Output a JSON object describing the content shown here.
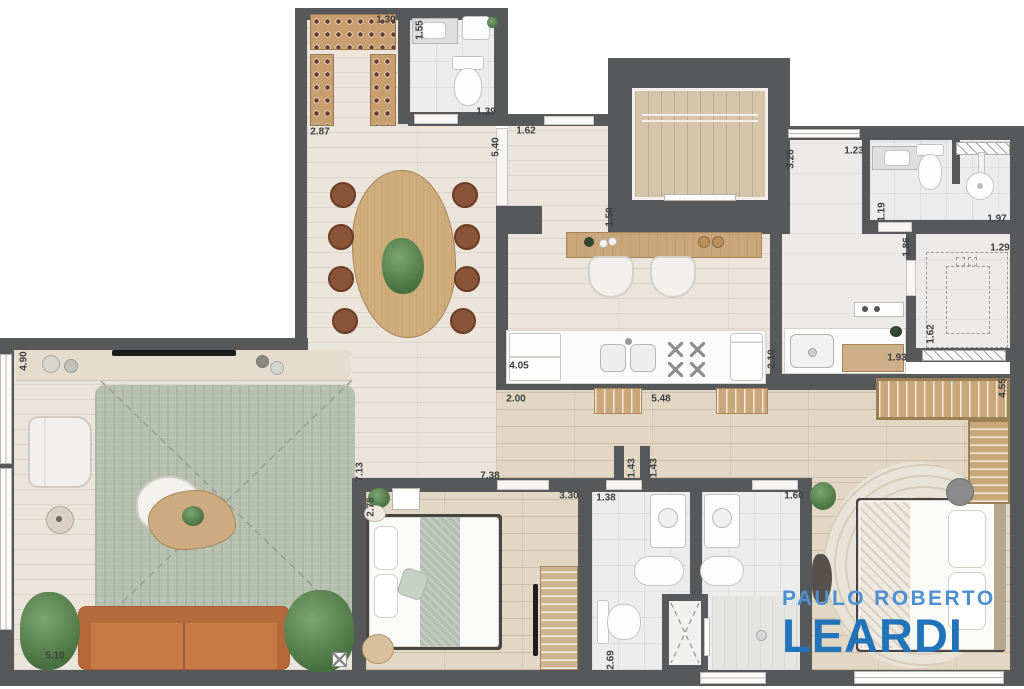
{
  "brand": {
    "line1": "PAULO ROBERTO",
    "line2": "LEARDI"
  },
  "colors": {
    "wall": "#57585a",
    "floor_tile": "#ebe4db",
    "floor_wood": "#e2d6c4",
    "floor_bath": "#ececec",
    "rug_living": "#b7bfae",
    "rug_master": "#e9e2d6",
    "sofa": "#c2713e",
    "wood_furniture": "#caa77a",
    "dining_chair": "#8a5438",
    "plant": "#47703f",
    "brand_light_blue": "#4c90d3",
    "brand_bold_blue": "#2173ba"
  },
  "icons": {
    "shower-head": "circle",
    "stove-burner": "x-cross",
    "shower-glass": "dashed-x",
    "floor-drain": "boxed-x"
  },
  "dimension_labels": [
    {
      "text": "1.30",
      "x": 386,
      "y": 20,
      "vertical": false
    },
    {
      "text": "1.55",
      "x": 420,
      "y": 30,
      "vertical": true
    },
    {
      "text": "2.87",
      "x": 320,
      "y": 132,
      "vertical": false
    },
    {
      "text": "1.39",
      "x": 486,
      "y": 112,
      "vertical": false
    },
    {
      "text": "5.40",
      "x": 496,
      "y": 147,
      "vertical": true
    },
    {
      "text": "1.62",
      "x": 526,
      "y": 131,
      "vertical": false
    },
    {
      "text": "1.50",
      "x": 610,
      "y": 217,
      "vertical": true
    },
    {
      "text": "3.26",
      "x": 791,
      "y": 159,
      "vertical": true
    },
    {
      "text": "1.23",
      "x": 854,
      "y": 151,
      "vertical": false
    },
    {
      "text": "1.19",
      "x": 882,
      "y": 212,
      "vertical": true
    },
    {
      "text": "1.97",
      "x": 997,
      "y": 219,
      "vertical": false
    },
    {
      "text": "1.86",
      "x": 907,
      "y": 247,
      "vertical": true
    },
    {
      "text": "1.29",
      "x": 1000,
      "y": 248,
      "vertical": false
    },
    {
      "text": "1.62",
      "x": 931,
      "y": 334,
      "vertical": true
    },
    {
      "text": "1.93",
      "x": 897,
      "y": 358,
      "vertical": false
    },
    {
      "text": "4.05",
      "x": 519,
      "y": 366,
      "vertical": false
    },
    {
      "text": "2.10",
      "x": 772,
      "y": 359,
      "vertical": true
    },
    {
      "text": "4.90",
      "x": 24,
      "y": 361,
      "vertical": true
    },
    {
      "text": "2.00",
      "x": 516,
      "y": 399,
      "vertical": false
    },
    {
      "text": "5.48",
      "x": 661,
      "y": 399,
      "vertical": false
    },
    {
      "text": "4.55",
      "x": 1003,
      "y": 388,
      "vertical": true
    },
    {
      "text": "7.13",
      "x": 360,
      "y": 472,
      "vertical": true
    },
    {
      "text": "7.38",
      "x": 490,
      "y": 476,
      "vertical": false
    },
    {
      "text": "2.75",
      "x": 371,
      "y": 507,
      "vertical": true
    },
    {
      "text": "3.30",
      "x": 569,
      "y": 496,
      "vertical": false
    },
    {
      "text": "1.38",
      "x": 606,
      "y": 498,
      "vertical": false
    },
    {
      "text": "1.43",
      "x": 632,
      "y": 468,
      "vertical": true
    },
    {
      "text": "1.43",
      "x": 654,
      "y": 468,
      "vertical": true
    },
    {
      "text": "1.60",
      "x": 794,
      "y": 496,
      "vertical": false
    },
    {
      "text": "5.10",
      "x": 55,
      "y": 656,
      "vertical": false
    },
    {
      "text": "2.69",
      "x": 611,
      "y": 660,
      "vertical": true
    }
  ]
}
